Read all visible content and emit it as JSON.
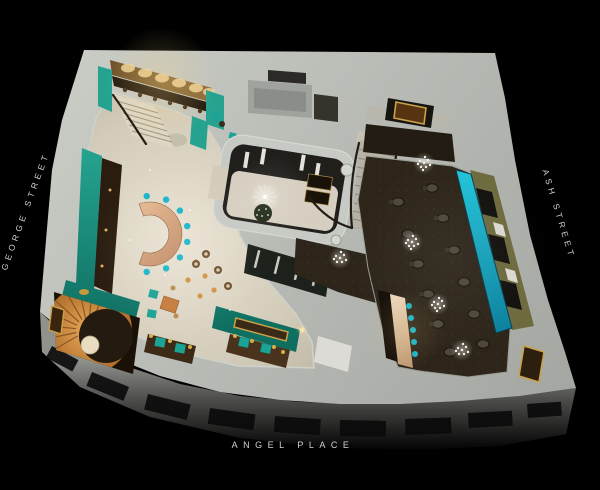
{
  "scene": {
    "type": "3d-cutaway-floorplan-render",
    "description": "Isometric cutaway render of a hotel ground floor with lobby, bars, staircases and restaurant",
    "background": "#000000"
  },
  "street_labels": {
    "left": "GEORGE STREET",
    "right": "ASH STREET",
    "bottom": "ANGEL PLACE"
  },
  "palette": {
    "bg": "#000000",
    "label": "#cfcfcf",
    "wall-light": "#bcbfb9",
    "wall-mid": "#a6a9a3",
    "facade": "#8f918d",
    "marble": "#ddd6c6",
    "teal": "#178174",
    "teal-bright": "#18b4ca",
    "teal-chair": "#1ba396",
    "gold": "#c9a04c",
    "amber": "#c8873e",
    "copper": "#d9a97e",
    "wood": "#2a1d10",
    "carpet": "#2d251a",
    "charcoal": "#201f1b",
    "olive": "#6d6a3e",
    "orange": "#c67c3c",
    "glow": "#f0d49a"
  }
}
